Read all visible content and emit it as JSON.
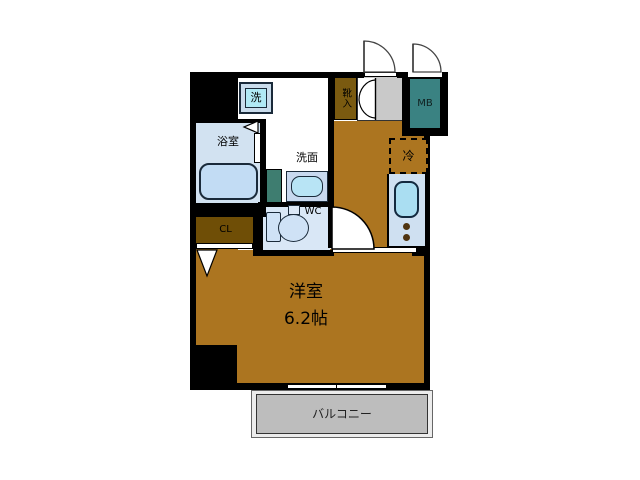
{
  "page": {
    "type": "apartment-floorplan",
    "background": "#ffffff"
  },
  "labels": {
    "main_room_name": "洋室",
    "main_room_size": "6.2帖",
    "balcony": "バルコニー",
    "bathroom": "浴室",
    "washstand": "洗面",
    "toilet": "WC",
    "closet": "CL",
    "shoe_cabinet": "靴入",
    "meter_box": "MB",
    "washing_machine": "洗",
    "refrigerator": "冷"
  },
  "colors": {
    "wall": "#000000",
    "flooring_brown": "#ac7520",
    "closet_brown": "#6f4e06",
    "shoe_cabinet_brown": "#7a5a10",
    "meter_box_teal": "#3a8282",
    "bath_door_teal": "#3e7d70",
    "bathroom_blue": "#d2e2f1",
    "tub_blue": "#c2dcf4",
    "counter_blue": "#cfe0f1",
    "sink_cyan": "#aadef2",
    "washer_cyan": "#b0e9f5",
    "wc_blue": "#d9e7f6",
    "basin_blue": "#b8e4f5",
    "genkan_gray": "#c9c9c9",
    "balcony_gray": "#bdbdbd",
    "burner_dot": "#4f3410"
  }
}
